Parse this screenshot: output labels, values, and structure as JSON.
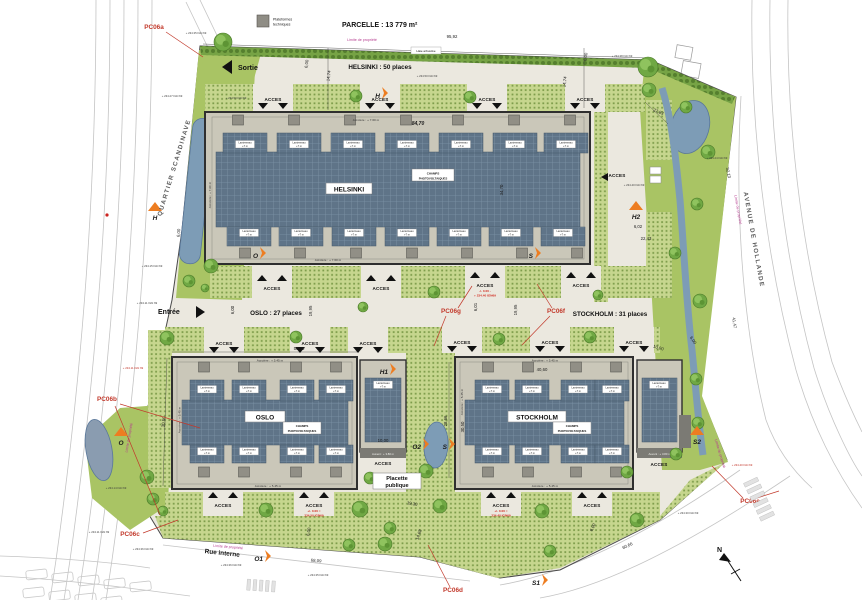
{
  "header": {
    "parcel_title": "PARCELLE : 13 779 m²",
    "legend_1": "Plateformes",
    "legend_2": "techniques",
    "haie": "Haie arbustive"
  },
  "flow": {
    "sortie": "Sortie",
    "entree": "Entrée"
  },
  "streets": {
    "left": "QUARTIER SCANDINAVE",
    "right": "AVENUE DE HOLLANDE",
    "bottom": "Rue interne",
    "north": "N"
  },
  "limite": "Limite de propriété",
  "acces_label": "ACCES",
  "champs": {
    "l1": "CHAMPS",
    "l2": "PHOTOVOLTAIQUES"
  },
  "lanterneau": {
    "l1": "Lanterneau",
    "l2": "+7 m"
  },
  "annexes": {
    "auvent": "Auvent : + 3.80 m"
  },
  "placette": {
    "l1": "Placette",
    "l2": "publique"
  },
  "buildings": {
    "helsinki": {
      "name": "HELSINKI",
      "places": "HELSINKI : 50 places",
      "acrotere": "Acrotère : + 7.60 m"
    },
    "oslo": {
      "name": "OSLO",
      "places": "OSLO : 27 places",
      "acrotere": "Acrotère : + 5.45 m"
    },
    "stockholm": {
      "name": "STOCKHOLM",
      "places": "STOCKHOLM : 31 places",
      "acrotere": "Acrotère : + 5.45 m"
    }
  },
  "dims": [
    {
      "t": "95,92",
      "x": 452,
      "y": 38,
      "r": 0
    },
    {
      "t": "6,00",
      "x": 308,
      "y": 64,
      "r": -83
    },
    {
      "t": "14,74",
      "x": 330,
      "y": 76,
      "r": -83
    },
    {
      "t": "6,00",
      "x": 587,
      "y": 57,
      "r": -83
    },
    {
      "t": "14,74",
      "x": 566,
      "y": 82,
      "r": -83
    },
    {
      "t": "84,70",
      "x": 418,
      "y": 125,
      "r": 0,
      "i": 1
    },
    {
      "t": "34,70",
      "x": 503,
      "y": 190,
      "r": -90
    },
    {
      "t": "27,83",
      "x": 658,
      "y": 113,
      "r": 22
    },
    {
      "t": "6,02",
      "x": 638,
      "y": 228,
      "r": 0
    },
    {
      "t": "22,43",
      "x": 646,
      "y": 240,
      "r": 0
    },
    {
      "t": "32,13",
      "x": 727,
      "y": 173,
      "r": 78
    },
    {
      "t": "41,47",
      "x": 733,
      "y": 323,
      "r": 82
    },
    {
      "t": "6,00",
      "x": 692,
      "y": 341,
      "r": 55
    },
    {
      "t": "50,40",
      "x": 299,
      "y": 350,
      "r": 0
    },
    {
      "t": "40,60",
      "x": 542,
      "y": 371,
      "r": 0
    },
    {
      "t": "19,95",
      "x": 312,
      "y": 311,
      "r": -90
    },
    {
      "t": "6,00",
      "x": 234,
      "y": 310,
      "r": -90
    },
    {
      "t": "19,95",
      "x": 517,
      "y": 310,
      "r": -90
    },
    {
      "t": "6,01",
      "x": 477,
      "y": 307,
      "r": -90
    },
    {
      "t": "30,50",
      "x": 165,
      "y": 422,
      "r": -84
    },
    {
      "t": "30,50",
      "x": 464,
      "y": 427,
      "r": -90
    },
    {
      "t": "28,66",
      "x": 447,
      "y": 421,
      "r": -90
    },
    {
      "t": "10,00",
      "x": 383,
      "y": 442,
      "r": 0
    },
    {
      "t": "10,00",
      "x": 658,
      "y": 349,
      "r": 18
    },
    {
      "t": "68,09",
      "x": 316,
      "y": 562,
      "r": 5
    },
    {
      "t": "60,66",
      "x": 628,
      "y": 547,
      "r": -25
    },
    {
      "t": "19,30",
      "x": 412,
      "y": 505,
      "r": 10
    },
    {
      "t": "14,68",
      "x": 420,
      "y": 535,
      "r": -70
    },
    {
      "t": "6,00",
      "x": 310,
      "y": 532,
      "r": -80
    },
    {
      "t": "6,00",
      "x": 594,
      "y": 528,
      "r": -65
    },
    {
      "t": "6,00",
      "x": 180,
      "y": 233,
      "r": -85
    }
  ],
  "spots": [
    {
      "t": "+ 234.35 IGN 69",
      "x": 196,
      "y": 34,
      "c": "sd"
    },
    {
      "t": "+ 234.27 IGN 69",
      "x": 172,
      "y": 97,
      "c": "sd"
    },
    {
      "t": "+ 234.50 IGN 69",
      "x": 427,
      "y": 77,
      "c": "sd"
    },
    {
      "t": "+ 234.50 IGN 69",
      "x": 236,
      "y": 99,
      "c": "sd"
    },
    {
      "t": "+ 234.38 IGN 69",
      "x": 622,
      "y": 57,
      "c": "sd"
    },
    {
      "t": "+ 234.40 IGN 69",
      "x": 634,
      "y": 186,
      "c": "sd"
    },
    {
      "t": "+ 234.15 IGN 69",
      "x": 152,
      "y": 267,
      "c": "sd"
    },
    {
      "t": "+ 234.11 IGN 69",
      "x": 147,
      "y": 304,
      "c": "sd"
    },
    {
      "t": "+ 234.11 IGN 69",
      "x": 133,
      "y": 369,
      "c": "sr"
    },
    {
      "t": "+ 234.14 IGN 69",
      "x": 116,
      "y": 489,
      "c": "sd"
    },
    {
      "t": "+ 234.11 IGN 69",
      "x": 99,
      "y": 533,
      "c": "sd"
    },
    {
      "t": "+ 234.36 IGN 69",
      "x": 143,
      "y": 550,
      "c": "sd"
    },
    {
      "t": "+ 234.36 IGN 69",
      "x": 231,
      "y": 566,
      "c": "sd"
    },
    {
      "t": "+ 234.35 IGN 69",
      "x": 318,
      "y": 576,
      "c": "sd"
    },
    {
      "t": "+ 234.30 IGN 69",
      "x": 688,
      "y": 514,
      "c": "sd"
    },
    {
      "t": "+ 234.24 IGN 69",
      "x": 717,
      "y": 159,
      "c": "sd"
    },
    {
      "t": "+ 234.40 IGN 69",
      "x": 742,
      "y": 466,
      "c": "sr"
    }
  ],
  "acces_pts": [
    {
      "x": 273,
      "y": 101,
      "d": "down",
      "b": "A"
    },
    {
      "x": 380,
      "y": 101,
      "d": "down",
      "b": "A"
    },
    {
      "x": 487,
      "y": 101,
      "d": "down",
      "b": "A"
    },
    {
      "x": 585,
      "y": 101,
      "d": "down",
      "b": "A"
    },
    {
      "x": 272,
      "y": 290,
      "d": "up",
      "b": "B"
    },
    {
      "x": 381,
      "y": 290,
      "d": "up",
      "b": "B"
    },
    {
      "x": 485,
      "y": 287,
      "d": "up",
      "b": "B"
    },
    {
      "x": 581,
      "y": 287,
      "d": "up",
      "b": "B"
    },
    {
      "x": 224,
      "y": 345,
      "d": "down",
      "b": "C"
    },
    {
      "x": 310,
      "y": 345,
      "d": "down",
      "b": "C"
    },
    {
      "x": 368,
      "y": 345,
      "d": "down",
      "b": "C"
    },
    {
      "x": 462,
      "y": 344,
      "d": "down",
      "b": "C"
    },
    {
      "x": 550,
      "y": 344,
      "d": "down",
      "b": "C"
    },
    {
      "x": 634,
      "y": 344,
      "d": "down",
      "b": "C"
    },
    {
      "x": 223,
      "y": 507,
      "d": "up",
      "b": "D"
    },
    {
      "x": 314,
      "y": 507,
      "d": "up",
      "b": "D"
    },
    {
      "x": 501,
      "y": 507,
      "d": "up",
      "b": "D"
    },
    {
      "x": 592,
      "y": 507,
      "d": "up",
      "b": "D"
    },
    {
      "x": 617,
      "y": 177,
      "d": "left"
    },
    {
      "x": 383,
      "y": 465,
      "d": "none"
    },
    {
      "x": 659,
      "y": 466,
      "d": "none"
    }
  ],
  "acces_red": [
    {
      "x": 485,
      "y": 292,
      "l1": "-/- 0.00 -",
      "l2": "+ 234.40 IGN69"
    },
    {
      "x": 314,
      "y": 512,
      "l1": "+/- 0.00 =",
      "l2": "234.50 IGN69"
    },
    {
      "x": 501,
      "y": 512,
      "l1": "+/- 0.00 =",
      "l2": "234.40 IGN69"
    }
  ],
  "markers_arrow": [
    {
      "t": "H",
      "x": 380,
      "y": 98
    },
    {
      "t": "O",
      "x": 258,
      "y": 258
    },
    {
      "t": "S",
      "x": 533,
      "y": 258
    },
    {
      "t": "H1",
      "x": 388,
      "y": 374
    },
    {
      "t": "O1",
      "x": 263,
      "y": 561
    },
    {
      "t": "O2",
      "x": 421,
      "y": 449
    },
    {
      "t": "S",
      "x": 447,
      "y": 449
    },
    {
      "t": "S1",
      "x": 540,
      "y": 585
    }
  ],
  "markers_tri": [
    {
      "t": "H",
      "x": 155,
      "y": 220,
      "c": "dark"
    },
    {
      "t": "H2",
      "x": 636,
      "y": 219,
      "c": "dark"
    },
    {
      "t": "O",
      "x": 121,
      "y": 445,
      "c": "dark"
    },
    {
      "t": "S2",
      "x": 697,
      "y": 444,
      "c": "orange"
    }
  ],
  "pc": [
    {
      "t": "PC06a",
      "x": 154,
      "y": 29,
      "lead": [
        [
          166,
          32
        ],
        [
          203,
          57
        ]
      ]
    },
    {
      "t": "PC06b",
      "x": 107,
      "y": 401,
      "lead": [
        [
          120,
          404
        ],
        [
          200,
          428
        ]
      ],
      "lead2": [
        [
          115,
          406
        ],
        [
          160,
          515
        ]
      ]
    },
    {
      "t": "PC06c",
      "x": 130,
      "y": 536,
      "lead": [
        [
          143,
          533
        ],
        [
          178,
          520
        ]
      ]
    },
    {
      "t": "PC06d",
      "x": 453,
      "y": 592,
      "lead": [
        [
          450,
          587
        ],
        [
          428,
          545
        ]
      ]
    },
    {
      "t": "PC06e",
      "x": 750,
      "y": 503,
      "lead": [
        [
          743,
          498
        ],
        [
          712,
          466
        ]
      ],
      "lead2": [
        [
          757,
          498
        ],
        [
          779,
          491
        ]
      ]
    },
    {
      "t": "PC06f",
      "x": 556,
      "y": 313,
      "lead": [
        [
          552,
          308
        ],
        [
          537,
          284
        ]
      ],
      "lead2": [
        [
          550,
          316
        ],
        [
          522,
          345
        ]
      ]
    },
    {
      "t": "PC06g",
      "x": 451,
      "y": 313,
      "lead": [
        [
          458,
          308
        ],
        [
          472,
          286
        ]
      ],
      "lead2": [
        [
          446,
          316
        ],
        [
          434,
          346
        ]
      ]
    }
  ],
  "limite_pts": [
    {
      "x": 362,
      "y": 41,
      "r": 0
    },
    {
      "x": 130,
      "y": 438,
      "r": -80
    },
    {
      "x": 228,
      "y": 548,
      "r": 5
    },
    {
      "x": 737,
      "y": 210,
      "r": 80
    },
    {
      "x": 719,
      "y": 454,
      "r": 73
    }
  ]
}
